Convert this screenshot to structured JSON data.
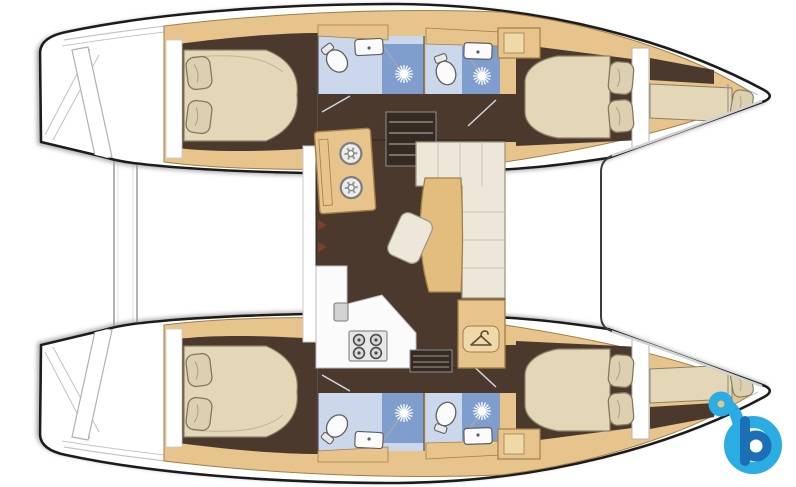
{
  "page": {
    "title": "Catamaran floor plan - top view",
    "background": "#ffffff",
    "width": 796,
    "height": 487
  },
  "colors": {
    "outline": "#1c1c1c",
    "deck": "#ffffff",
    "deck_line": "#c6c6c6",
    "wood": "#e6c48b",
    "wood_light": "#f0d9a8",
    "wood_stroke": "#a07f48",
    "floor": "#4b392e",
    "floor_dark": "#362a21",
    "bed": "#e4d7b7",
    "bed_stroke": "#8d8066",
    "pillow": "#dcd0b1",
    "pillow_stroke": "#84795d",
    "bath_pale": "#cbd8eb",
    "bath_mid": "#7f9ecd",
    "bath_wall": "#5a5a5a",
    "fixture": "#fbfbfb",
    "fixture_stroke": "#5f5f5f",
    "sofa": "#ece7d8",
    "sofa_stroke": "#9b9786",
    "table": "#e3bd7e",
    "table_stroke": "#a5814a",
    "steel": "#e7e7e7",
    "steel_stroke": "#8c8c8c",
    "accent": "#7c3f2c",
    "logo_light": "#2bace2",
    "logo_dark": "#1b6fb5"
  },
  "vessel": {
    "type": "catamaran",
    "view": "top-down interior layout plan",
    "orientation": "bows pointing right",
    "upper_hull": {
      "rooms": [
        "aft double cabin with two pillows",
        "aft bathroom: toilet, sink, shower",
        "forward bathroom: toilet, sink, shower",
        "forward double cabin with two pillows and wardrobe",
        "forepeak single berth with pillow"
      ]
    },
    "lower_hull": {
      "rooms": [
        "aft double cabin with two pillows",
        "aft bathroom: toilet, sink, shower",
        "forward bathroom: toilet, sink, shower",
        "forward double cabin with two pillows and wardrobe",
        "forepeak single berth with pillow"
      ]
    },
    "saloon": {
      "items": [
        "galley twin round sinks",
        "four-burner stove",
        "counter sink",
        "companionway steps to upper hull",
        "companionway steps to lower hull",
        "L-shaped sofa",
        "dining table",
        "stool",
        "hanging locker with hanger symbol"
      ]
    },
    "deck": {
      "items": [
        "stern platform bar",
        "sugar-scoop transom steps",
        "toe-rail lines",
        "foredeck divider line"
      ]
    }
  },
  "watermark": {
    "name": "boataround-logo",
    "glyph": "stylized letter b",
    "light_blue": "#2bace2",
    "dark_blue": "#1b6fb5"
  }
}
